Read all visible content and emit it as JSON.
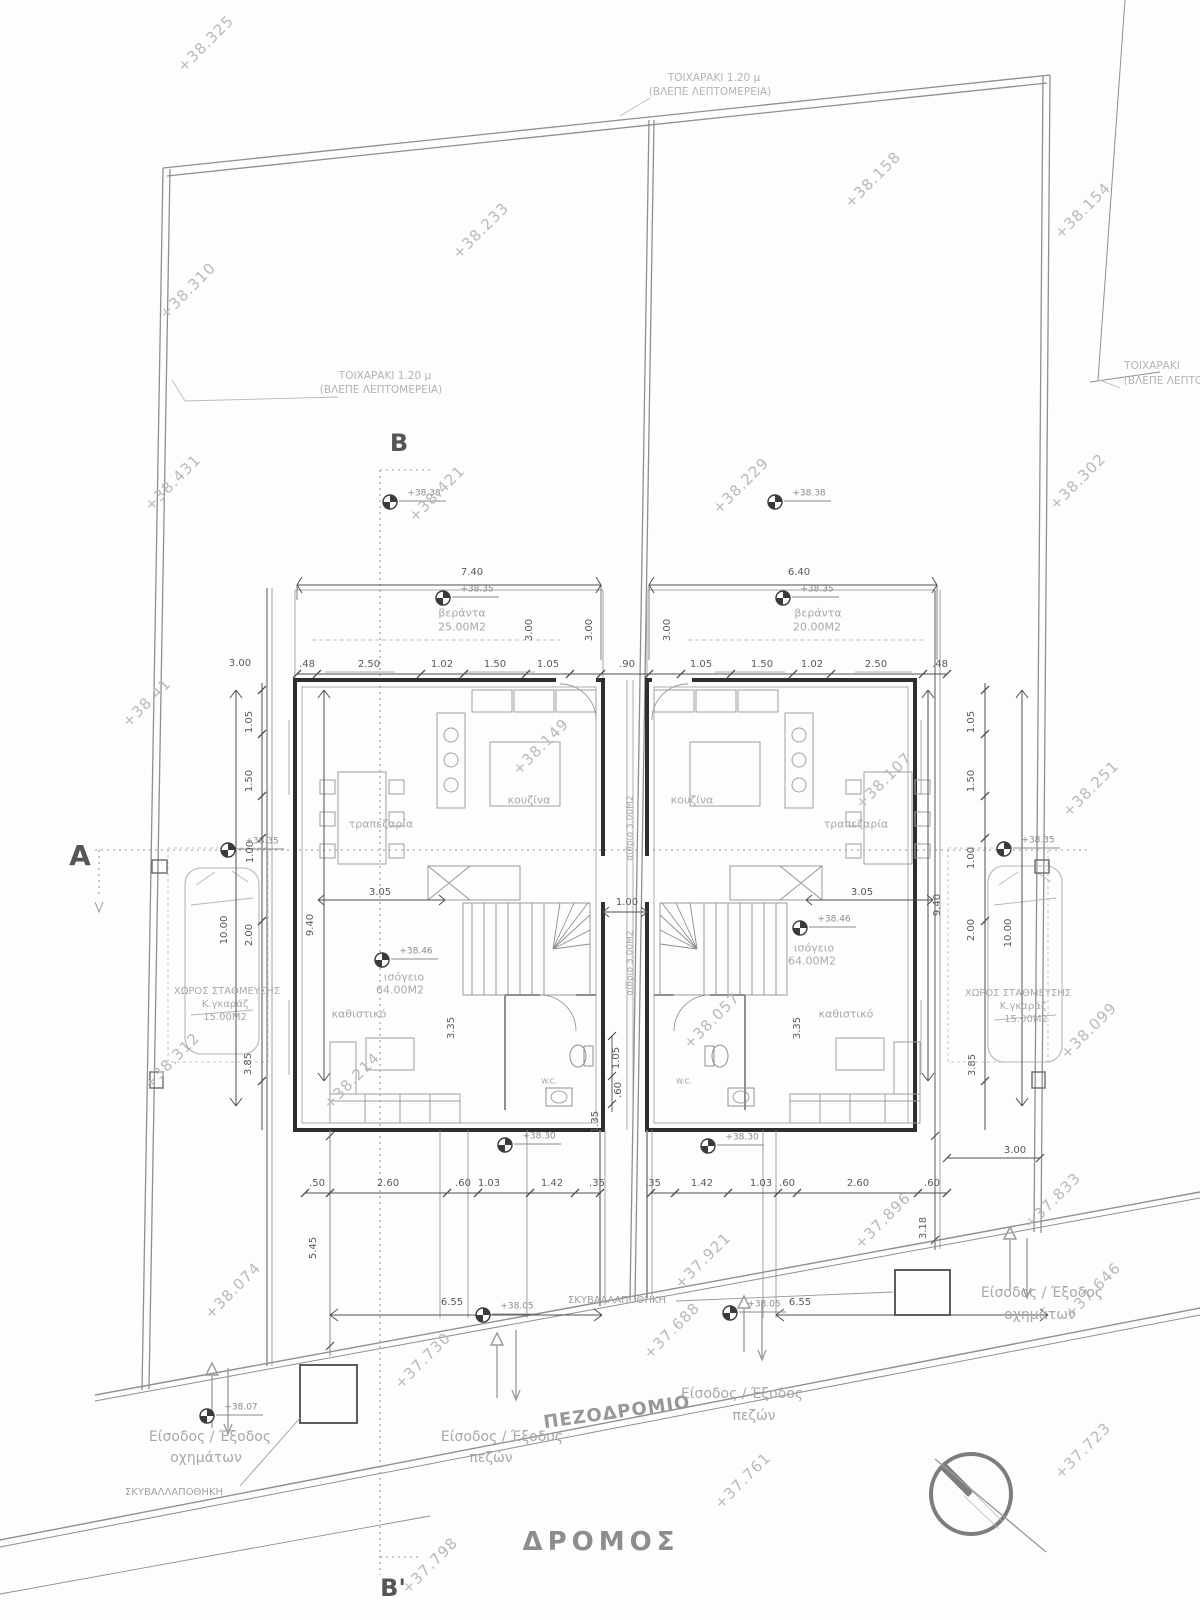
{
  "colors": {
    "wall": "#2e2e2e",
    "line": "#9a9a9a",
    "faint": "#c2c2c2",
    "dim": "#555555",
    "text": "#a6a6a6"
  },
  "markers": [
    {
      "t": "+38.38",
      "x": 390,
      "y": 502
    },
    {
      "t": "+38.38",
      "x": 775,
      "y": 502
    },
    {
      "t": "+38.35",
      "x": 443,
      "y": 598
    },
    {
      "t": "+38.35",
      "x": 783,
      "y": 598
    },
    {
      "t": "+38.35",
      "x": 228,
      "y": 850
    },
    {
      "t": "+38.35",
      "x": 1004,
      "y": 849
    },
    {
      "t": "+38.46",
      "x": 382,
      "y": 960
    },
    {
      "t": "+38.46",
      "x": 800,
      "y": 928
    },
    {
      "t": "+38.30",
      "x": 505,
      "y": 1145
    },
    {
      "t": "+38.30",
      "x": 708,
      "y": 1146
    },
    {
      "t": "+38.05",
      "x": 483,
      "y": 1315
    },
    {
      "t": "+38.05",
      "x": 730,
      "y": 1313
    },
    {
      "t": "+38.07",
      "x": 207,
      "y": 1416
    }
  ],
  "labels": [
    {
      "name": "elevation-38-325",
      "t": "+38.325",
      "x": 206,
      "y": 44,
      "rot": -45,
      "cls": "elev"
    },
    {
      "name": "elevation-38-233",
      "t": "+38.233",
      "x": 481,
      "y": 231,
      "rot": -45,
      "cls": "elev"
    },
    {
      "name": "elevation-38-158",
      "t": "+38.158",
      "x": 873,
      "y": 180,
      "rot": -45,
      "cls": "elev"
    },
    {
      "name": "elevation-38-154",
      "t": "+38.154",
      "x": 1083,
      "y": 211,
      "rot": -45,
      "cls": "elev"
    },
    {
      "name": "elevation-38-310",
      "t": "+38.310",
      "x": 188,
      "y": 291,
      "rot": -45,
      "cls": "elev"
    },
    {
      "name": "elevation-38-431",
      "t": "+38.431",
      "x": 173,
      "y": 483,
      "rot": -45,
      "cls": "elev"
    },
    {
      "name": "elevation-38-421",
      "t": "+38.421",
      "x": 437,
      "y": 494,
      "rot": -45,
      "cls": "elev"
    },
    {
      "name": "elevation-38-229",
      "t": "+38.229",
      "x": 741,
      "y": 486,
      "rot": -45,
      "cls": "elev"
    },
    {
      "name": "elevation-38-302",
      "t": "+38.302",
      "x": 1078,
      "y": 482,
      "rot": -45,
      "cls": "elev"
    },
    {
      "name": "elevation-38-41",
      "t": "+38.41",
      "x": 147,
      "y": 703,
      "rot": -45,
      "cls": "elev"
    },
    {
      "name": "elevation-38-149",
      "t": "+38.149",
      "x": 541,
      "y": 747,
      "rot": -45,
      "cls": "elev"
    },
    {
      "name": "elevation-38-107",
      "t": "+38.107",
      "x": 884,
      "y": 781,
      "rot": -45,
      "cls": "elev"
    },
    {
      "name": "elevation-38-251",
      "t": "+38.251",
      "x": 1091,
      "y": 789,
      "rot": -45,
      "cls": "elev"
    },
    {
      "name": "elevation-38-312",
      "t": "+38.312",
      "x": 172,
      "y": 1061,
      "rot": -45,
      "cls": "elev"
    },
    {
      "name": "elevation-38-214",
      "t": "+38.214",
      "x": 352,
      "y": 1081,
      "rot": -45,
      "cls": "elev"
    },
    {
      "name": "elevation-38-057",
      "t": "+38.057",
      "x": 712,
      "y": 1021,
      "rot": -45,
      "cls": "elev"
    },
    {
      "name": "elevation-38-099",
      "t": "+38.099",
      "x": 1089,
      "y": 1031,
      "rot": -45,
      "cls": "elev"
    },
    {
      "name": "elevation-37-833",
      "t": "+37.833",
      "x": 1053,
      "y": 1201,
      "rot": -45,
      "cls": "elev"
    },
    {
      "name": "elevation-37-896",
      "t": "+37.896",
      "x": 883,
      "y": 1221,
      "rot": -45,
      "cls": "elev"
    },
    {
      "name": "elevation-37-921",
      "t": "+37.921",
      "x": 703,
      "y": 1261,
      "rot": -45,
      "cls": "elev"
    },
    {
      "name": "elevation-38-074",
      "t": "+38.074",
      "x": 233,
      "y": 1291,
      "rot": -45,
      "cls": "elev"
    },
    {
      "name": "elevation-37-730",
      "t": "+37.730",
      "x": 423,
      "y": 1361,
      "rot": -45,
      "cls": "elev"
    },
    {
      "name": "elevation-37-688",
      "t": "+37.688",
      "x": 672,
      "y": 1331,
      "rot": -45,
      "cls": "elev"
    },
    {
      "name": "elevation-37-761",
      "t": "+37.761",
      "x": 743,
      "y": 1481,
      "rot": -45,
      "cls": "elev"
    },
    {
      "name": "elevation-37-723",
      "t": "+37.723",
      "x": 1083,
      "y": 1451,
      "rot": -45,
      "cls": "elev"
    },
    {
      "name": "elevation-37-646",
      "t": "+37.646",
      "x": 1093,
      "y": 1291,
      "rot": -45,
      "cls": "elev"
    },
    {
      "name": "elevation-37-798",
      "t": "+37.798",
      "x": 430,
      "y": 1566,
      "rot": -45,
      "cls": "elev"
    },
    {
      "name": "wall-note-top-1",
      "t": "ΤΟΙΧΑΡΑΚΙ 1.20 μ",
      "x": 714,
      "y": 78,
      "cls": "note"
    },
    {
      "name": "wall-note-top-2",
      "t": "(ΒΛΕΠΕ ΛΕΠΤΟΜΕΡΕΙΑ)",
      "x": 710,
      "y": 92,
      "cls": "note"
    },
    {
      "name": "wall-note-left-1",
      "t": "ΤΟΙΧΑΡΑΚΙ 1.20 μ",
      "x": 385,
      "y": 376,
      "cls": "note"
    },
    {
      "name": "wall-note-left-2",
      "t": "(ΒΛΕΠΕ ΛΕΠΤΟΜΕΡΕΙΑ)",
      "x": 381,
      "y": 390,
      "cls": "note"
    },
    {
      "name": "wall-note-right-1",
      "t": "ΤΟΙΧΑΡΑΚΙ",
      "x": 1152,
      "y": 366,
      "cls": "note"
    },
    {
      "name": "wall-note-right-2",
      "t": "(ΒΛΕΠΕ ΛΕΠΤΟΜΕΡΕΙΑ)",
      "x": 1185,
      "y": 381,
      "cls": "note"
    },
    {
      "name": "section-marker-b",
      "t": "B",
      "x": 399,
      "y": 443,
      "cls": "sect"
    },
    {
      "name": "section-marker-b-prime",
      "t": "B'",
      "x": 393,
      "y": 1588,
      "cls": "sect"
    },
    {
      "name": "section-marker-a",
      "t": "A",
      "x": 80,
      "y": 856,
      "cls": "sect",
      "fs": 28
    },
    {
      "name": "sidewalk-label",
      "t": "ΠΕΖΟΔΡΟΜΙΟ",
      "x": 617,
      "y": 1413,
      "rot": -8,
      "cls": "road"
    },
    {
      "name": "road-label",
      "t": "ΔΡΟΜΟΣ",
      "x": 601,
      "y": 1542,
      "cls": "bigroad"
    },
    {
      "name": "vehicle-entry-left-1",
      "t": "Είσοδος / Έξοδος",
      "x": 210,
      "y": 1437,
      "cls": "entr"
    },
    {
      "name": "vehicle-entry-left-2",
      "t": "οχημάτων",
      "x": 206,
      "y": 1458,
      "cls": "entr"
    },
    {
      "name": "pedestrian-entry-left-1",
      "t": "Είσοδος / Έξοδος",
      "x": 502,
      "y": 1437,
      "cls": "entr"
    },
    {
      "name": "pedestrian-entry-left-2",
      "t": "πεζών",
      "x": 491,
      "y": 1458,
      "cls": "entr"
    },
    {
      "name": "pedestrian-entry-right-1",
      "t": "Είσοδος / Έξοδος",
      "x": 742,
      "y": 1394,
      "cls": "entr"
    },
    {
      "name": "pedestrian-entry-right-2",
      "t": "πεζών",
      "x": 754,
      "y": 1416,
      "cls": "entr"
    },
    {
      "name": "vehicle-entry-right-1",
      "t": "Είσοδος / Έξοδος",
      "x": 1042,
      "y": 1293,
      "cls": "entr"
    },
    {
      "name": "vehicle-entry-right-2",
      "t": "οχημάτων",
      "x": 1040,
      "y": 1315,
      "cls": "entr"
    },
    {
      "name": "garbage-store-left",
      "t": "ΣΚΥΒΑΛΛΑΠΟΘΗΚΗ",
      "x": 174,
      "y": 1493,
      "cls": "store"
    },
    {
      "name": "garbage-store-right",
      "t": "ΣΚΥΒΑΛΛΑΠΟΘΗΚΗ",
      "x": 617,
      "y": 1301,
      "cls": "store"
    },
    {
      "name": "room-kitchen-left",
      "t": "κουζίνα",
      "x": 529,
      "y": 800,
      "cls": "room"
    },
    {
      "name": "room-dining-left",
      "t": "τραπεζαρία",
      "x": 381,
      "y": 824,
      "cls": "room"
    },
    {
      "name": "room-living-left",
      "t": "καθιστικό",
      "x": 359,
      "y": 1014,
      "cls": "room"
    },
    {
      "name": "room-groundfloor-left-1",
      "t": "ισόγειο",
      "x": 404,
      "y": 977,
      "cls": "room"
    },
    {
      "name": "room-groundfloor-left-2",
      "t": "64.00Μ2",
      "x": 400,
      "y": 990,
      "cls": "room"
    },
    {
      "name": "room-kitchen-right",
      "t": "κουζίνα",
      "x": 692,
      "y": 800,
      "cls": "room"
    },
    {
      "name": "room-dining-right",
      "t": "τραπεζαρία",
      "x": 856,
      "y": 824,
      "cls": "room"
    },
    {
      "name": "room-living-right",
      "t": "καθιστικό",
      "x": 846,
      "y": 1014,
      "cls": "room"
    },
    {
      "name": "room-groundfloor-right-1",
      "t": "ισόγειο",
      "x": 814,
      "y": 948,
      "cls": "room"
    },
    {
      "name": "room-groundfloor-right-2",
      "t": "64.00Μ2",
      "x": 812,
      "y": 961,
      "cls": "room"
    },
    {
      "name": "veranda-left-1",
      "t": "βεράντα",
      "x": 462,
      "y": 613,
      "cls": "room"
    },
    {
      "name": "veranda-left-2",
      "t": "25.00Μ2",
      "x": 462,
      "y": 627,
      "cls": "room"
    },
    {
      "name": "veranda-right-1",
      "t": "βεράντα",
      "x": 818,
      "y": 613,
      "cls": "room"
    },
    {
      "name": "veranda-right-2",
      "t": "20.00Μ2",
      "x": 817,
      "y": 627,
      "cls": "room"
    },
    {
      "name": "wc-label-left",
      "t": "W.C.",
      "x": 549,
      "y": 1082,
      "cls": "tiny"
    },
    {
      "name": "wc-label-right",
      "t": "W.C.",
      "x": 684,
      "y": 1082,
      "cls": "tiny"
    },
    {
      "name": "atrium-upper",
      "t": "αίθριο 3.00Μ2",
      "x": 631,
      "y": 828,
      "rot": -90,
      "cls": "room",
      "fs": 9
    },
    {
      "name": "atrium-lower",
      "t": "αίθριο 3.00Μ2",
      "x": 631,
      "y": 963,
      "rot": -90,
      "cls": "room",
      "fs": 9
    },
    {
      "name": "parking-left-1",
      "t": "ΧΩΡΟΣ ΣΤΑΘΜΕΥΣΗΣ",
      "x": 227,
      "y": 992,
      "cls": "room",
      "fs": 10
    },
    {
      "name": "parking-left-2",
      "t": "Κ.γκαράζ",
      "x": 225,
      "y": 1005,
      "cls": "room",
      "fs": 10
    },
    {
      "name": "parking-left-3",
      "t": "15.00Μ2",
      "x": 225,
      "y": 1018,
      "cls": "room",
      "fs": 10
    },
    {
      "name": "parking-right-1",
      "t": "ΧΩΡΟΣ ΣΤΑΘΜΕΥΣΗΣ",
      "x": 1018,
      "y": 994,
      "cls": "room",
      "fs": 10
    },
    {
      "name": "parking-right-2",
      "t": "Κ.γκαράζ",
      "x": 1023,
      "y": 1007,
      "cls": "room",
      "fs": 10
    },
    {
      "name": "parking-right-3",
      "t": "15.00Μ2",
      "x": 1026,
      "y": 1020,
      "cls": "room",
      "fs": 10
    },
    {
      "name": "dim-740",
      "t": "7.40",
      "x": 472,
      "y": 573,
      "cls": "dim"
    },
    {
      "name": "dim-640",
      "t": "6.40",
      "x": 799,
      "y": 573,
      "cls": "dim"
    },
    {
      "name": "dim-300-left",
      "t": "3.00",
      "x": 240,
      "y": 664,
      "cls": "dim"
    },
    {
      "name": "dim",
      "t": ".48",
      "x": 307,
      "y": 665,
      "cls": "dim"
    },
    {
      "name": "dim",
      "t": "2.50",
      "x": 369,
      "y": 665,
      "cls": "dim"
    },
    {
      "name": "dim",
      "t": "1.02",
      "x": 442,
      "y": 665,
      "cls": "dim"
    },
    {
      "name": "dim",
      "t": "1.50",
      "x": 495,
      "y": 665,
      "cls": "dim"
    },
    {
      "name": "dim",
      "t": "1.05",
      "x": 548,
      "y": 665,
      "cls": "dim"
    },
    {
      "name": "dim",
      "t": ".90",
      "x": 627,
      "y": 665,
      "cls": "dim"
    },
    {
      "name": "dim",
      "t": "1.05",
      "x": 701,
      "y": 665,
      "cls": "dim"
    },
    {
      "name": "dim",
      "t": "1.50",
      "x": 762,
      "y": 665,
      "cls": "dim"
    },
    {
      "name": "dim",
      "t": "1.02",
      "x": 812,
      "y": 665,
      "cls": "dim"
    },
    {
      "name": "dim",
      "t": "2.50",
      "x": 876,
      "y": 665,
      "cls": "dim"
    },
    {
      "name": "dim",
      "t": ".48",
      "x": 940,
      "y": 665,
      "cls": "dim"
    },
    {
      "name": "dim-305-left",
      "t": "3.05",
      "x": 380,
      "y": 893,
      "cls": "dim"
    },
    {
      "name": "dim-305-right",
      "t": "3.05",
      "x": 862,
      "y": 893,
      "cls": "dim"
    },
    {
      "name": "dim-100-center",
      "t": "1.00",
      "x": 627,
      "y": 903,
      "cls": "dim"
    },
    {
      "name": "dim",
      "t": ".50",
      "x": 317,
      "y": 1184,
      "cls": "dim"
    },
    {
      "name": "dim",
      "t": "2.60",
      "x": 388,
      "y": 1184,
      "cls": "dim"
    },
    {
      "name": "dim",
      "t": ".60",
      "x": 463,
      "y": 1184,
      "cls": "dim"
    },
    {
      "name": "dim",
      "t": "1.03",
      "x": 489,
      "y": 1184,
      "cls": "dim"
    },
    {
      "name": "dim",
      "t": "1.42",
      "x": 552,
      "y": 1184,
      "cls": "dim"
    },
    {
      "name": "dim",
      "t": ".35",
      "x": 597,
      "y": 1184,
      "cls": "dim"
    },
    {
      "name": "dim",
      "t": ".35",
      "x": 653,
      "y": 1184,
      "cls": "dim"
    },
    {
      "name": "dim",
      "t": "1.42",
      "x": 702,
      "y": 1184,
      "cls": "dim"
    },
    {
      "name": "dim",
      "t": "1.03",
      "x": 761,
      "y": 1184,
      "cls": "dim"
    },
    {
      "name": "dim",
      "t": ".60",
      "x": 787,
      "y": 1184,
      "cls": "dim"
    },
    {
      "name": "dim",
      "t": "2.60",
      "x": 858,
      "y": 1184,
      "cls": "dim"
    },
    {
      "name": "dim",
      "t": ".60",
      "x": 932,
      "y": 1184,
      "cls": "dim"
    },
    {
      "name": "dim-655-left",
      "t": "6.55",
      "x": 452,
      "y": 1303,
      "cls": "dim"
    },
    {
      "name": "dim-655-right",
      "t": "6.55",
      "x": 800,
      "y": 1303,
      "cls": "dim"
    },
    {
      "name": "dim-300-right-low",
      "t": "3.00",
      "x": 1015,
      "y": 1151,
      "cls": "dim"
    },
    {
      "name": "dimv",
      "t": "3.00",
      "x": 530,
      "y": 630,
      "rot": -90,
      "cls": "dimv"
    },
    {
      "name": "dimv",
      "t": "3.00",
      "x": 590,
      "y": 630,
      "rot": -90,
      "cls": "dimv"
    },
    {
      "name": "dimv",
      "t": "3.00",
      "x": 668,
      "y": 630,
      "rot": -90,
      "cls": "dimv"
    },
    {
      "name": "dimv",
      "t": "1.05",
      "x": 250,
      "y": 722,
      "rot": -90,
      "cls": "dimv"
    },
    {
      "name": "dimv",
      "t": "1.50",
      "x": 250,
      "y": 781,
      "rot": -90,
      "cls": "dimv"
    },
    {
      "name": "dimv",
      "t": "1.00",
      "x": 251,
      "y": 852,
      "rot": -90,
      "cls": "dimv"
    },
    {
      "name": "dimv",
      "t": "2.00",
      "x": 250,
      "y": 935,
      "rot": -90,
      "cls": "dimv"
    },
    {
      "name": "dimv",
      "t": "3.85",
      "x": 249,
      "y": 1064,
      "rot": -90,
      "cls": "dimv"
    },
    {
      "name": "dimv",
      "t": "10.00",
      "x": 225,
      "y": 930,
      "rot": -90,
      "cls": "dimv"
    },
    {
      "name": "dimv",
      "t": "9.40",
      "x": 311,
      "y": 925,
      "rot": -90,
      "cls": "dimv"
    },
    {
      "name": "dimv",
      "t": "1.05",
      "x": 972,
      "y": 722,
      "rot": -90,
      "cls": "dimv"
    },
    {
      "name": "dimv",
      "t": "1.50",
      "x": 972,
      "y": 781,
      "rot": -90,
      "cls": "dimv"
    },
    {
      "name": "dimv",
      "t": "1.00",
      "x": 972,
      "y": 858,
      "rot": -90,
      "cls": "dimv"
    },
    {
      "name": "dimv",
      "t": "2.00",
      "x": 972,
      "y": 930,
      "rot": -90,
      "cls": "dimv"
    },
    {
      "name": "dimv",
      "t": "3.85",
      "x": 973,
      "y": 1065,
      "rot": -90,
      "cls": "dimv"
    },
    {
      "name": "dimv",
      "t": "9.40",
      "x": 938,
      "y": 905,
      "rot": -90,
      "cls": "dimv"
    },
    {
      "name": "dimv",
      "t": "10.00",
      "x": 1009,
      "y": 933,
      "rot": -90,
      "cls": "dimv"
    },
    {
      "name": "dimv",
      "t": "1.05",
      "x": 617,
      "y": 1058,
      "rot": -90,
      "cls": "dimv"
    },
    {
      "name": "dimv",
      "t": ".60",
      "x": 619,
      "y": 1090,
      "rot": -90,
      "cls": "dimv"
    },
    {
      "name": "dimv",
      "t": "1.35",
      "x": 596,
      "y": 1122,
      "rot": -90,
      "cls": "dimv"
    },
    {
      "name": "dimv",
      "t": "3.35",
      "x": 452,
      "y": 1028,
      "rot": -90,
      "cls": "dimv"
    },
    {
      "name": "dimv",
      "t": "3.35",
      "x": 798,
      "y": 1028,
      "rot": -90,
      "cls": "dimv"
    },
    {
      "name": "dimv",
      "t": "5.45",
      "x": 314,
      "y": 1248,
      "rot": -90,
      "cls": "dimv"
    },
    {
      "name": "dimv",
      "t": "3.18",
      "x": 924,
      "y": 1228,
      "rot": -90,
      "cls": "dimv"
    }
  ]
}
